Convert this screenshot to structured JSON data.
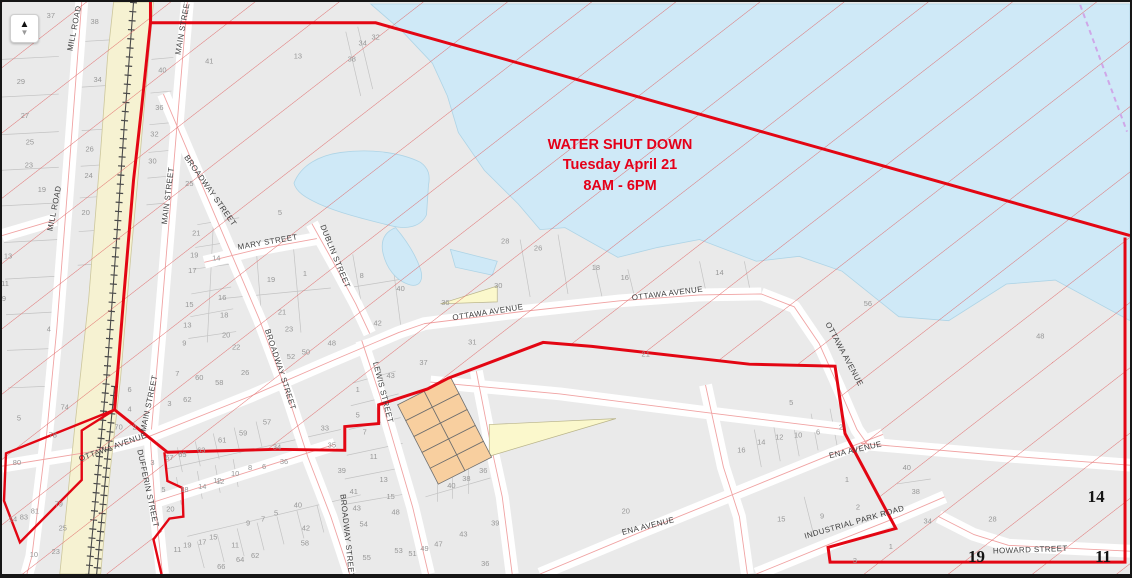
{
  "map": {
    "notice": {
      "line1": "WATER SHUT DOWN",
      "line2": "Tuesday April 21",
      "line3": "8AM - 6PM"
    },
    "controls": {
      "north_arrow_up": "▲",
      "north_arrow_down": "▼"
    },
    "colors": {
      "boundary": "#e30613",
      "hatch": "#e06666",
      "water": "#cfe9f7",
      "rail": "#f6f2d2",
      "orange": "#f8cf9f",
      "yellow": "#fbf8cc",
      "centerline": "#f0a3a3",
      "muni": "#cfa7e8",
      "notice": "#e50019"
    },
    "street_labels": [
      [
        "MILL ROAD",
        75,
        27,
        -79
      ],
      [
        "MILL ROAD",
        55,
        209,
        -79
      ],
      [
        "MAIN STREET",
        184,
        25,
        -80
      ],
      [
        "MAIN STREET",
        169,
        196,
        -83
      ],
      [
        "MAIN STREET",
        150,
        406,
        -78
      ],
      [
        "BROADWAY STREET",
        207,
        192,
        55
      ],
      [
        "BROADWAY STREET",
        277,
        372,
        72
      ],
      [
        "BROADWAY STREET",
        344,
        540,
        84
      ],
      [
        "MARY STREET",
        267,
        245,
        -10
      ],
      [
        "DUBLIN STREET",
        332,
        258,
        68
      ],
      [
        "LEWIS STREET",
        380,
        395,
        76
      ],
      [
        "OTTAWA AVENUE",
        112,
        452,
        -20
      ],
      [
        "OTTAWA AVENUE",
        488,
        316,
        -9
      ],
      [
        "OTTAWA AVENUE",
        668,
        297,
        -7
      ],
      [
        "OTTAWA AVENUE",
        843,
        357,
        62
      ],
      [
        "DUFFERIN STREET",
        144,
        492,
        78
      ],
      [
        "ENA AVENUE",
        649,
        532,
        -14
      ],
      [
        "ENA AVENUE",
        857,
        455,
        -13
      ],
      [
        "INDUSTRIAL PARK ROAD",
        856,
        528,
        -16
      ],
      [
        "HOWARD STREET",
        1032,
        556,
        -2
      ]
    ],
    "parcel_numbers": [
      [
        "37",
        49,
        16
      ],
      [
        "38",
        93,
        22
      ],
      [
        "40",
        161,
        71
      ],
      [
        "41",
        208,
        62
      ],
      [
        "29",
        19,
        83
      ],
      [
        "34",
        96,
        81
      ],
      [
        "36",
        158,
        109
      ],
      [
        "27",
        23,
        117
      ],
      [
        "32",
        153,
        136
      ],
      [
        "25",
        28,
        144
      ],
      [
        "26",
        88,
        151
      ],
      [
        "30",
        151,
        163
      ],
      [
        "23",
        27,
        167
      ],
      [
        "24",
        87,
        178
      ],
      [
        "19",
        40,
        192
      ],
      [
        "25",
        188,
        186
      ],
      [
        "20",
        84,
        215
      ],
      [
        "13",
        297,
        57
      ],
      [
        "38",
        351,
        60
      ],
      [
        "34",
        362,
        44
      ],
      [
        "32",
        375,
        38
      ],
      [
        "5",
        279,
        215
      ],
      [
        "21",
        195,
        236
      ],
      [
        "19",
        193,
        258
      ],
      [
        "14",
        215,
        261
      ],
      [
        "17",
        191,
        274
      ],
      [
        "16",
        221,
        301
      ],
      [
        "15",
        188,
        308
      ],
      [
        "18",
        223,
        319
      ],
      [
        "13",
        186,
        329
      ],
      [
        "20",
        225,
        339
      ],
      [
        "9",
        183,
        347
      ],
      [
        "22",
        235,
        351
      ],
      [
        "1",
        304,
        277
      ],
      [
        "19",
        270,
        283
      ],
      [
        "21",
        281,
        316
      ],
      [
        "23",
        288,
        333
      ],
      [
        "52",
        290,
        361
      ],
      [
        "50",
        305,
        356
      ],
      [
        "48",
        331,
        347
      ],
      [
        "8",
        361,
        279
      ],
      [
        "40",
        400,
        292
      ],
      [
        "42",
        377,
        327
      ],
      [
        "26",
        244,
        377
      ],
      [
        "58",
        218,
        387
      ],
      [
        "60",
        198,
        382
      ],
      [
        "7",
        176,
        378
      ],
      [
        "62",
        186,
        404
      ],
      [
        "3",
        168,
        408
      ],
      [
        "13",
        6,
        259
      ],
      [
        "11",
        3,
        287
      ],
      [
        "9",
        2,
        302
      ],
      [
        "4",
        47,
        333
      ],
      [
        "6",
        128,
        394
      ],
      [
        "4",
        128,
        414
      ],
      [
        "70",
        117,
        432
      ],
      [
        "2",
        133,
        432
      ],
      [
        "74",
        63,
        412
      ],
      [
        "5",
        17,
        423
      ],
      [
        "78",
        51,
        440
      ],
      [
        "80",
        15,
        468
      ],
      [
        "79",
        57,
        510
      ],
      [
        "81",
        33,
        517
      ],
      [
        "83",
        22,
        523
      ],
      [
        "14",
        11,
        525
      ],
      [
        "25",
        61,
        534
      ],
      [
        "23",
        54,
        558
      ],
      [
        "10",
        32,
        561
      ],
      [
        "28",
        505,
        244
      ],
      [
        "26",
        538,
        251
      ],
      [
        "18",
        596,
        271
      ],
      [
        "16",
        625,
        281
      ],
      [
        "14",
        720,
        276
      ],
      [
        "30",
        498,
        289
      ],
      [
        "36",
        445,
        306
      ],
      [
        "31",
        472,
        346
      ],
      [
        "37",
        423,
        367
      ],
      [
        "21",
        646,
        358
      ],
      [
        "56",
        869,
        307
      ],
      [
        "48",
        1042,
        340
      ],
      [
        "43",
        390,
        380
      ],
      [
        "1",
        357,
        394
      ],
      [
        "5",
        357,
        420
      ],
      [
        "7",
        364,
        437
      ],
      [
        "11",
        373,
        462
      ],
      [
        "39",
        341,
        476
      ],
      [
        "13",
        383,
        485
      ],
      [
        "41",
        353,
        497
      ],
      [
        "15",
        390,
        502
      ],
      [
        "43",
        356,
        514
      ],
      [
        "48",
        395,
        518
      ],
      [
        "54",
        363,
        530
      ],
      [
        "40",
        451,
        491
      ],
      [
        "38",
        466,
        484
      ],
      [
        "36",
        483,
        476
      ],
      [
        "63",
        200,
        455
      ],
      [
        "61",
        221,
        445
      ],
      [
        "65",
        181,
        460
      ],
      [
        "67",
        168,
        463
      ],
      [
        "57",
        266,
        427
      ],
      [
        "59",
        242,
        438
      ],
      [
        "3",
        151,
        468
      ],
      [
        "5",
        162,
        495
      ],
      [
        "18",
        183,
        495
      ],
      [
        "14",
        201,
        492
      ],
      [
        "12",
        219,
        487
      ],
      [
        "20",
        169,
        515
      ],
      [
        "11",
        176,
        556
      ],
      [
        "19",
        186,
        551
      ],
      [
        "17",
        201,
        548
      ],
      [
        "15",
        212,
        543
      ],
      [
        "33",
        324,
        433
      ],
      [
        "35",
        331,
        450
      ],
      [
        "34",
        276,
        452
      ],
      [
        "36",
        283,
        467
      ],
      [
        "8",
        249,
        473
      ],
      [
        "6",
        263,
        472
      ],
      [
        "10",
        234,
        479
      ],
      [
        "12",
        216,
        486
      ],
      [
        "9",
        247,
        529
      ],
      [
        "7",
        262,
        525
      ],
      [
        "5",
        275,
        519
      ],
      [
        "40",
        297,
        511
      ],
      [
        "42",
        305,
        534
      ],
      [
        "58",
        304,
        549
      ],
      [
        "64",
        239,
        566
      ],
      [
        "62",
        254,
        562
      ],
      [
        "66",
        220,
        573
      ],
      [
        "11",
        234,
        551
      ],
      [
        "55",
        366,
        564
      ],
      [
        "53",
        398,
        557
      ],
      [
        "51",
        412,
        560
      ],
      [
        "49",
        424,
        555
      ],
      [
        "47",
        438,
        550
      ],
      [
        "43",
        463,
        540
      ],
      [
        "36",
        485,
        570
      ],
      [
        "39",
        495,
        529
      ],
      [
        "20",
        626,
        517
      ],
      [
        "16",
        742,
        455
      ],
      [
        "14",
        762,
        447
      ],
      [
        "12",
        780,
        442
      ],
      [
        "10",
        799,
        440
      ],
      [
        "6",
        819,
        437
      ],
      [
        "2",
        842,
        432
      ],
      [
        "5",
        792,
        407
      ],
      [
        "1",
        848,
        485
      ],
      [
        "2",
        859,
        513
      ],
      [
        "15",
        782,
        525
      ],
      [
        "9",
        823,
        522
      ],
      [
        "40",
        908,
        473
      ],
      [
        "38",
        917,
        497
      ],
      [
        "34",
        929,
        527
      ],
      [
        "28",
        994,
        525
      ],
      [
        "1",
        892,
        553
      ],
      [
        "3",
        856,
        567
      ]
    ],
    "sheet_numbers": [
      [
        "19",
        978,
        566
      ],
      [
        "11",
        1105,
        566
      ],
      [
        "14",
        1098,
        505
      ]
    ]
  }
}
